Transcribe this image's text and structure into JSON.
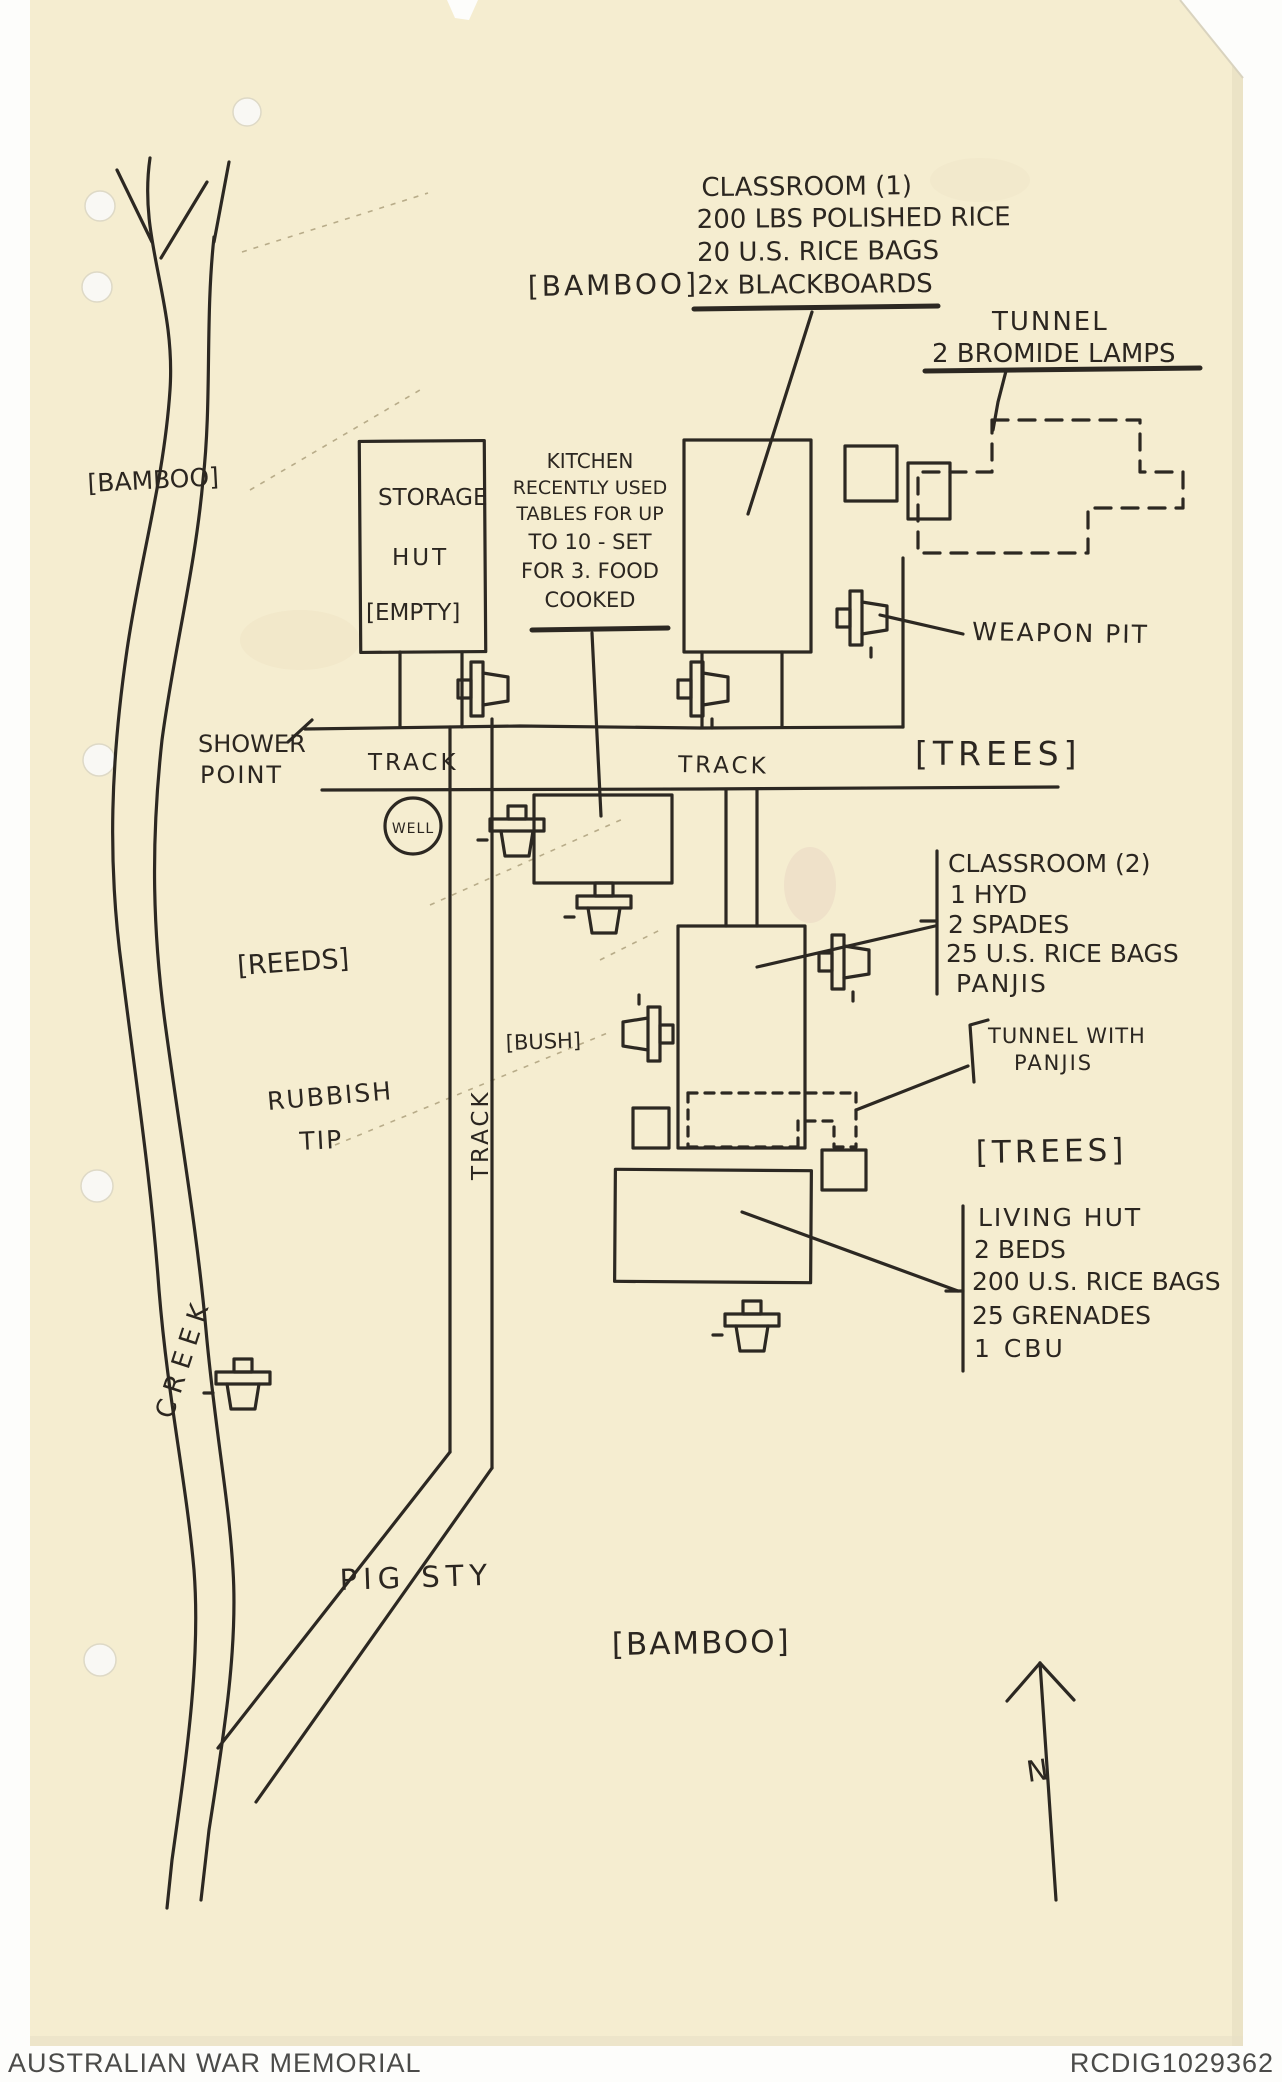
{
  "footer": {
    "archive_name": "AUSTRALIAN WAR MEMORIAL",
    "archive_id": "RCDIG1029362"
  },
  "map": {
    "vegetation": {
      "bamboo_top": "[BAMBOO]",
      "bamboo_left": "[BAMBOO]",
      "bamboo_bottom": "[BAMBOO]",
      "trees_upper": "[TREES]",
      "trees_lower": "[TREES]",
      "reeds": "[REEDS]",
      "bush": "[BUSH]"
    },
    "features": {
      "creek": "CREEK",
      "track_upper": "TRACK",
      "track_right": "TRACK",
      "track_vertical": "TRACK",
      "shower_point": [
        "SHOWER",
        "POINT"
      ],
      "well": "WELL",
      "rubbish_tip": [
        "RUBBISH",
        "TIP"
      ],
      "pig_sty": "PIG STY",
      "weapon_pit": "WEAPON PIT",
      "north": "N"
    },
    "annotations": {
      "classroom1": [
        "CLASSROOM (1)",
        "200 LBS POLISHED RICE",
        "20 U.S. RICE BAGS",
        "2x BLACKBOARDS"
      ],
      "tunnel_lamps": [
        "TUNNEL",
        "2 BROMIDE LAMPS"
      ],
      "storage_hut": [
        "STORAGE",
        "HUT",
        "[EMPTY]"
      ],
      "kitchen": [
        "KITCHEN",
        "RECENTLY USED",
        "TABLES FOR UP",
        "TO 10 - SET",
        "FOR 3. FOOD",
        "COOKED"
      ],
      "classroom2": [
        "CLASSROOM (2)",
        "1 HYD",
        "2 SPADES",
        "25 U.S. RICE BAGS",
        "PANJIS"
      ],
      "tunnel_panjis": [
        "TUNNEL WITH",
        "PANJIS"
      ],
      "living_hut": [
        "LIVING HUT",
        "2 BEDS",
        "200 U.S. RICE BAGS",
        "25 GRENADES",
        "1 CBU"
      ]
    }
  },
  "colors": {
    "paper": "#f5edd0",
    "ink": "#2c2822",
    "scan_background": "#fdfdfb",
    "footer_text": "#4b4b49"
  }
}
